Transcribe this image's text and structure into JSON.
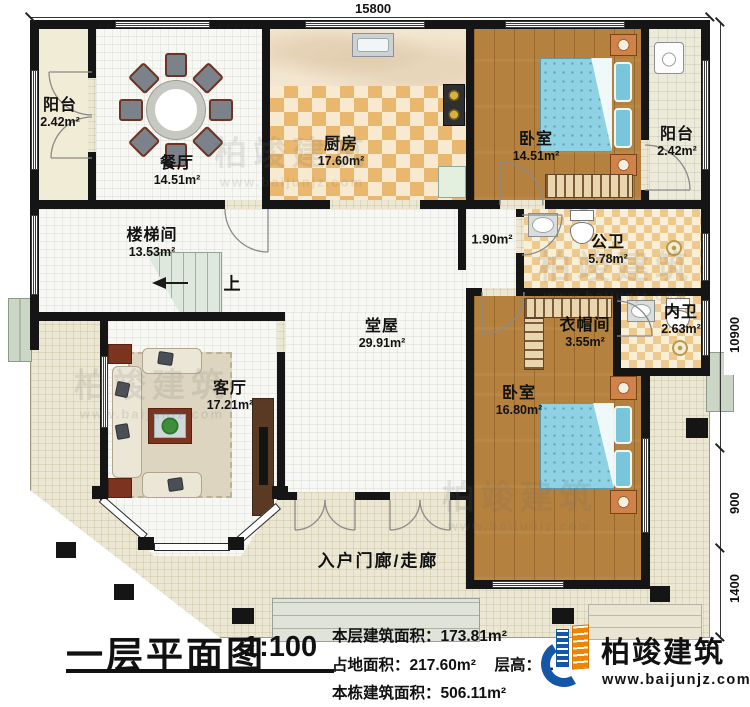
{
  "dimensions": {
    "top": "15800",
    "right_upper": "10900",
    "right_middle": "900",
    "right_lower": "1400"
  },
  "rooms": {
    "balcony_tl": {
      "name": "阳台",
      "area": "2.42m²"
    },
    "dining": {
      "name": "餐厅",
      "area": "14.51m²"
    },
    "kitchen": {
      "name": "厨房",
      "area": "17.60m²"
    },
    "bedroom_top": {
      "name": "卧室",
      "area": "14.51m²"
    },
    "balcony_right": {
      "name": "阳台",
      "area": "2.42m²"
    },
    "stairwell": {
      "name": "楼梯间",
      "area": "13.53m²"
    },
    "corridor": {
      "area": "1.90m²"
    },
    "public_bath": {
      "name": "公卫",
      "area": "5.78m²"
    },
    "ensuite_bath": {
      "name": "内卫",
      "area": "2.63m²"
    },
    "cloakroom": {
      "name": "衣帽间",
      "area": "3.55m²"
    },
    "main_hall": {
      "name": "堂屋",
      "area": "29.91m²"
    },
    "living": {
      "name": "客厅",
      "area": "17.21m²"
    },
    "bedroom_bottom": {
      "name": "卧室",
      "area": "16.80m²"
    },
    "entrance_porch": {
      "name": "入户门廊/走廊"
    }
  },
  "stairs": {
    "up_label": "上"
  },
  "title_block": {
    "title": "一层平面图",
    "scale": "1:100",
    "floor_area_label": "本层建筑面积：",
    "floor_area_value": "173.81m²",
    "land_area_label": "占地面积：",
    "land_area_value": "217.60m²",
    "storey_label": "层高：",
    "storey_value": "3.",
    "total_area_label": "本栋建筑面积：",
    "total_area_value": "506.11m²"
  },
  "logo": {
    "name": "柏竣建筑",
    "url": "www.baijunjz.com"
  },
  "watermark": {
    "text": "柏竣建筑",
    "url": "www.baijunjz.com"
  },
  "colors": {
    "wall": "#151515",
    "checker": "#e9b76d",
    "wood": "#b5813e",
    "bed": "#8ed2e3",
    "porch": "#ebe7d2",
    "logo_blue": "#1456a8",
    "logo_orange": "#f08300"
  }
}
